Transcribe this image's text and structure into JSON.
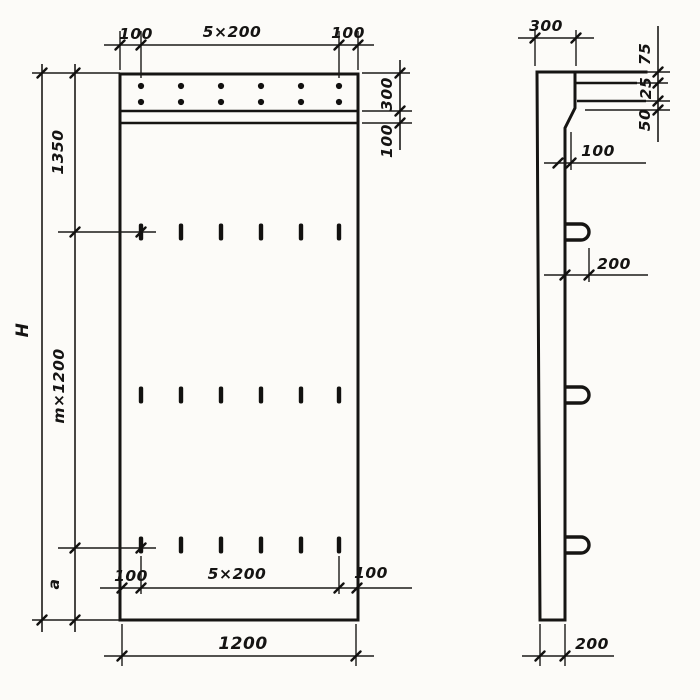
{
  "drawing": {
    "kind": "precast concrete panel working drawing, front view and side view",
    "features": {
      "anchor_dot_rows": 2,
      "anchor_dots_per_row": 6,
      "slot_rows": 3,
      "slots_per_row": 6,
      "side_lifting_loops": 3
    },
    "front_view": {
      "top_left_spacing": "100",
      "top_pitch": "5×200",
      "top_right_spacing": "100",
      "cap_height": "300",
      "cap_strip": "100",
      "upper_height": "1350",
      "module_height": "m×1200",
      "lower_height": "a",
      "overall_height": "H",
      "bottom_left_spacing": "100",
      "bottom_pitch": "5×200",
      "bottom_right_spacing": "100",
      "overall_width": "1200"
    },
    "side_view": {
      "top_width": "300",
      "edge_offset_top": "75",
      "edge_offset_mid": "25",
      "edge_offset_bot": "50",
      "ledge_depth": "100",
      "loop_projection": "200",
      "panel_thickness": "200"
    }
  }
}
